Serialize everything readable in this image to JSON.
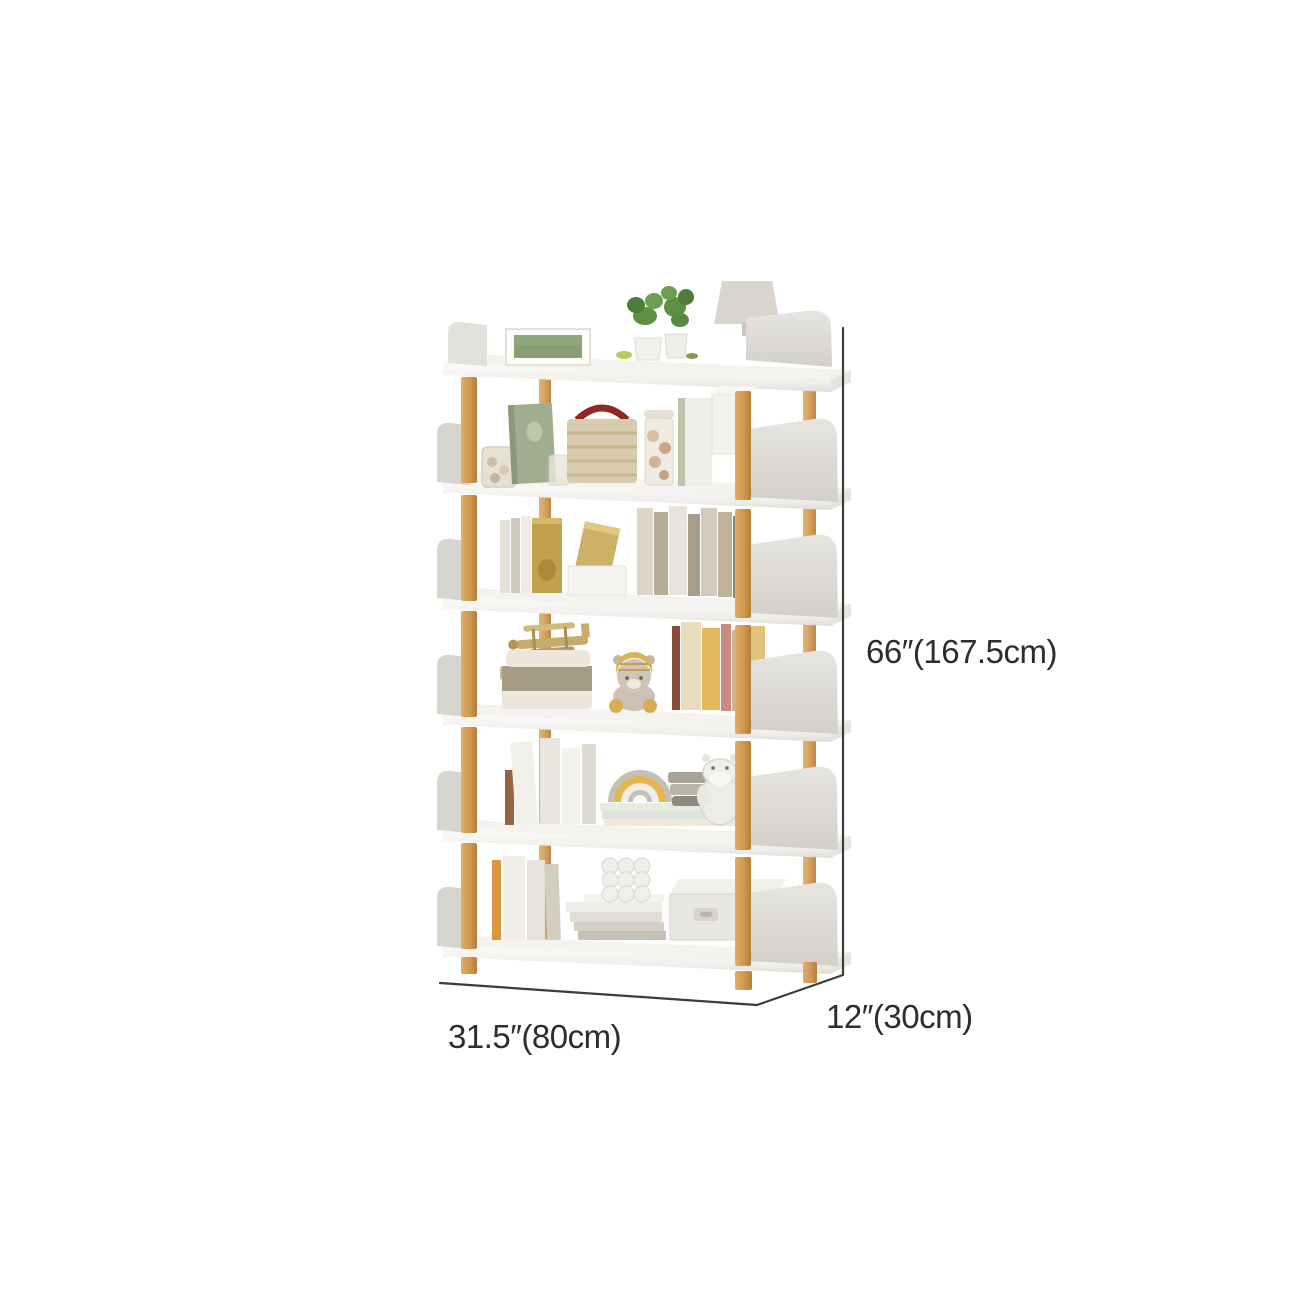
{
  "page": {
    "background": "#ffffff"
  },
  "illustration": {
    "name": "six-tier-white-and-wood-bookshelf",
    "shelf_count": 6,
    "colors": {
      "background": "#ffffff",
      "board": "#f6f5f2",
      "board_front": "#fbfaf8",
      "board_edge": "#e9e7e2",
      "panel": "#e2e0db",
      "panel_dark": "#d6d3cd",
      "panel_side": "#d2cfc9",
      "wood": "#d29a55",
      "wood_light": "#e2ad68",
      "wood_dark": "#b67e3c",
      "dimension_line": "#3c3c3c",
      "label_text": "#2d2d2d"
    },
    "shelves": [
      {
        "name": "top-shelf",
        "items": [
          "picture-frame",
          "potted-plant",
          "potted-plant",
          "table-lamp"
        ]
      },
      {
        "name": "shelf-2",
        "items": [
          "glass-jar",
          "green-book",
          "glass-cup",
          "woven-basket-bag",
          "candy-jar",
          "magazine-file",
          "white-box"
        ]
      },
      {
        "name": "shelf-3",
        "items": [
          "standing-books",
          "gold-book",
          "leaning-book",
          "white-box",
          "book-row"
        ]
      },
      {
        "name": "shelf-4",
        "items": [
          "toy-airplane",
          "storage-case",
          "teddy-bear",
          "book-row"
        ]
      },
      {
        "name": "shelf-5",
        "items": [
          "white-books",
          "rainbow-toy",
          "pastel-book-stack",
          "folded-cloth-stack",
          "hippo-plush"
        ]
      },
      {
        "name": "shelf-6",
        "items": [
          "standing-books",
          "book-stack",
          "bubble-candle",
          "storage-box"
        ]
      }
    ]
  },
  "dimensions": {
    "height_label": "66″(167.5cm)",
    "width_label": "31.5″(80cm)",
    "depth_label": "12″(30cm)"
  }
}
